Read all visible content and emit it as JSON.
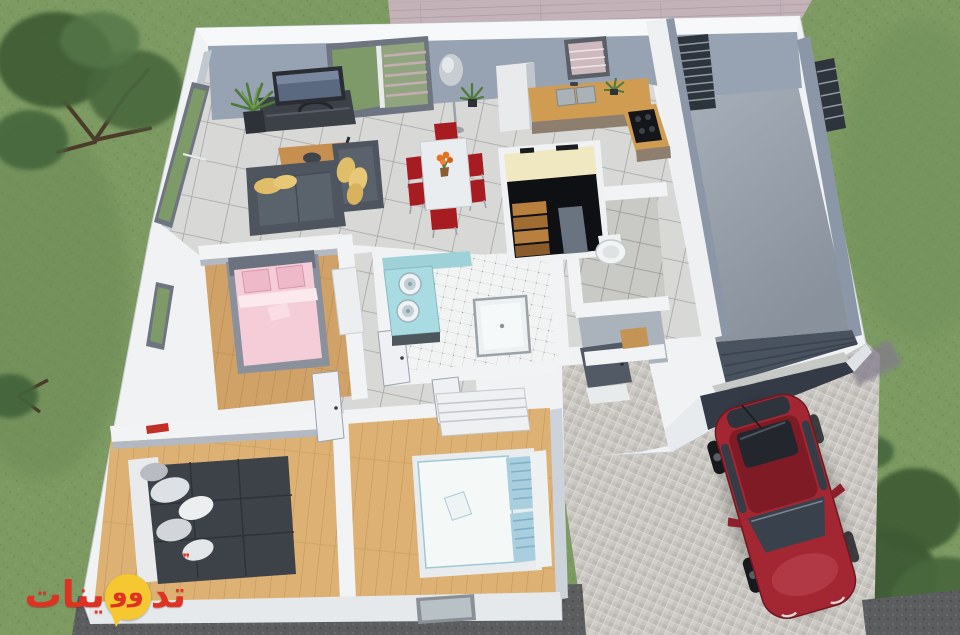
{
  "watermark": {
    "text_full": "تدوينات",
    "text_right": "تد",
    "bubble_marks": "وو",
    "text_left": "ينات",
    "quote_mark": "❞"
  },
  "palette": {
    "grass": "#7c9a62",
    "tree_dark": "#3f5d34",
    "deck": "#c3b2b8",
    "gravel": "#5b5d5e",
    "cobble": "#c7c4bf",
    "wall_white": "#f0f2f4",
    "wall_top": "#f6f8fa",
    "wall_gray": "#97a2b2",
    "wall_gray_dark": "#8b97a7",
    "wall_face_shadow": "#cdd3da",
    "garage_floor_light": "#a8b0ba",
    "garage_floor_dark": "#88919c",
    "roller_door": "#49525f",
    "door_gray": "#525a66",
    "storage_floor": "#aab2bc",
    "sofa": "#4e555e",
    "sofa_seat": "#5a626c",
    "cushion": "#e0bd68",
    "coffee_table": "#c78f4f",
    "tv": "#2a2e34",
    "tv_screen": "#5a6880",
    "dining_table": "#e9edf0",
    "chair_red": "#a61c20",
    "flower_orange": "#e8701e",
    "counter_wood": "#cf9c52",
    "cabinet_front": "#8d7e6e",
    "cooktop": "#14161a",
    "sink_steel": "#aab2b8",
    "fridge": "#e8eaec",
    "stair_wall_cream": "#efe8c0",
    "stair_pit": "#0e1014",
    "stair_wood": "#b97f3e",
    "bath_blue": "#a9dce2",
    "bath_wall_blue": "#9fd2d8",
    "shower_white": "#eef1f2",
    "toilet_white": "#f2f4f4",
    "bed_pink": "#f4cdd8",
    "pillow_pink": "#eeb9c8",
    "bed_frame_gray": "#8a919c",
    "bed_dark": "#3c4248",
    "bed_base_white": "#e8eaec",
    "bed_white": "#f4f8f7",
    "pillow_blue": "#a9cede",
    "shelf_white": "#eef0f2",
    "red_decor": "#c03028",
    "car_red": "#a32733",
    "car_roof": "#7e1b24",
    "car_glass": "#353c46",
    "wheel_dark": "#17191d",
    "wm_red": "#e03222",
    "wm_yellow": "#f5c832"
  }
}
